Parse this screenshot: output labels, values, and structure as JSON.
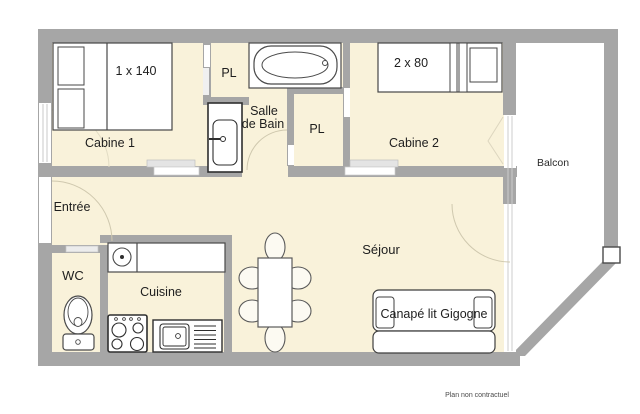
{
  "plan": {
    "rooms": {
      "entree": {
        "label": "Entrée"
      },
      "cabine1": {
        "label": "Cabine 1"
      },
      "pl_hall": {
        "label": "PL"
      },
      "salle_de_bain": {
        "label_line1": "Salle",
        "label_line2": "de Bain"
      },
      "pl_cabine2": {
        "label": "PL"
      },
      "cabine2": {
        "label": "Cabine 2"
      },
      "balcon": {
        "label": "Balcon"
      },
      "wc": {
        "label": "WC"
      },
      "cuisine": {
        "label": "Cuisine"
      },
      "sejour": {
        "label": "Séjour"
      }
    },
    "furniture": {
      "bed_cabine1": {
        "label": "1 x 140"
      },
      "bed_cabine2": {
        "label": "2 x 80"
      },
      "sofa": {
        "label": "Canapé lit Gigogne"
      }
    },
    "footer": {
      "note": "Plan non contractuel"
    },
    "colors": {
      "wall": "#a6a6a6",
      "floor": "#f9f2da",
      "furniture_outline": "#3f3f3f",
      "background": "#ffffff"
    }
  }
}
